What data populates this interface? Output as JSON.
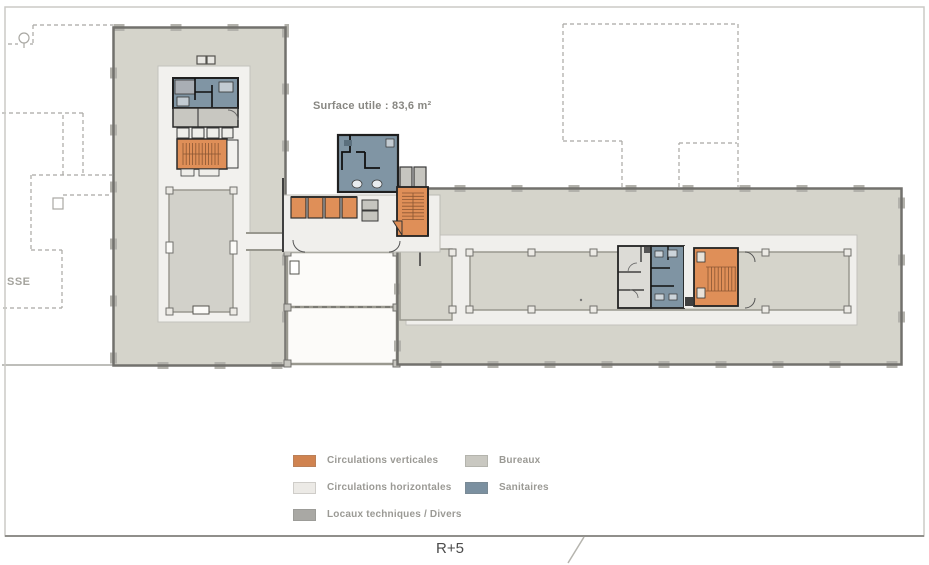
{
  "sheet": {
    "floor_label": "R+5",
    "surface_label": "Surface utile : 83,6 m²",
    "terrace_label": "SSE"
  },
  "legend": {
    "items": [
      {
        "label": "Circulations verticales",
        "color": "#d08350"
      },
      {
        "label": "Circulations horizontales",
        "color": "#eceae6"
      },
      {
        "label": "Locaux techniques / Divers",
        "color": "#a9a8a4"
      },
      {
        "label": "Bureaux",
        "color": "#c9c8c1"
      },
      {
        "label": "Sanitaires",
        "color": "#7b90a0"
      }
    ]
  },
  "plan_colors": {
    "bureaux_fill": "#d5d4cb",
    "wall": "#72716d",
    "circulation_fill": "#f0efec",
    "sanitaires_fill": "#8095a4",
    "vertical_circulation_fill": "#df8f58",
    "technical_fill": "#c8c7c1"
  }
}
